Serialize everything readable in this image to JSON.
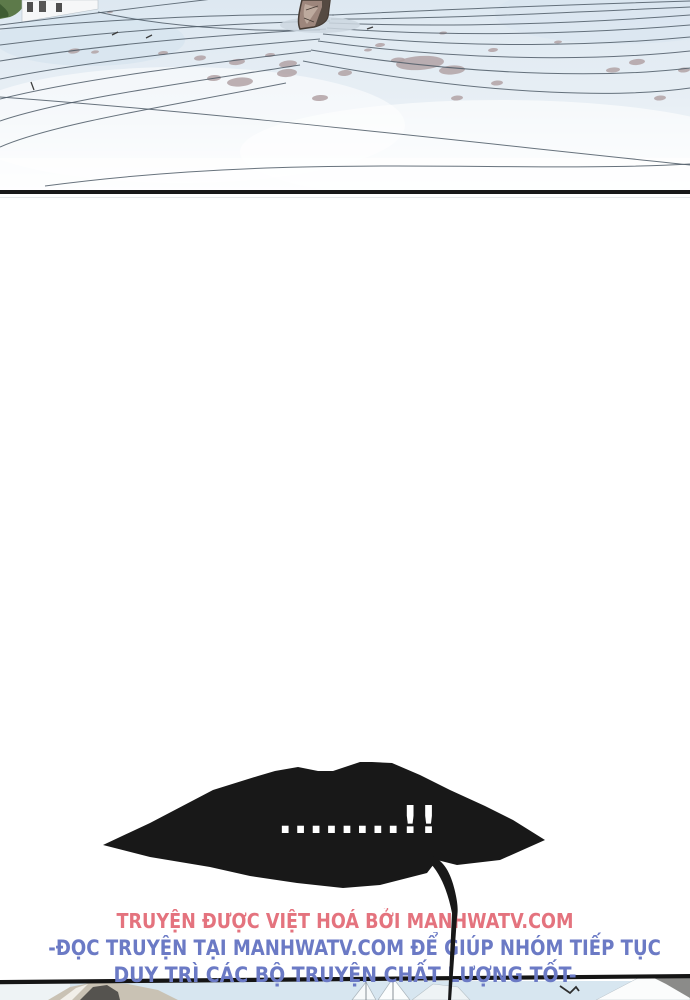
{
  "colors": {
    "panel_bg_top": "#dde8f1",
    "panel_bg_bottom": "#fbfdfe",
    "contour_line": "#4e5a66",
    "stain": "#b2a2a4",
    "divider": "#191919",
    "bubble": "#181818",
    "bubble_text": "#ffffff",
    "credit_line1": "#e4737e",
    "credit_line23": "#6b7ac5",
    "sky": "#d7e6f0"
  },
  "speech_bubble": {
    "text": "........!!"
  },
  "credits": {
    "line1": "TRUYỆN ĐƯỢC VIỆT HOÁ BỞI MANHWATV.COM",
    "line2": "-ĐỌC TRUYỆN TẠI MANHWATV.COM ĐỂ GIÚP NHÓM TIẾP TỤC",
    "line3": "DUY TRÌ CÁC BỘ TRUYỆN CHẤT LƯỢNG TỐT-"
  },
  "artwork": {
    "stains": [
      [
        74,
        51,
        6,
        2.5,
        -8
      ],
      [
        95,
        52,
        4,
        1.6,
        -8
      ],
      [
        163,
        53,
        5,
        2,
        -6
      ],
      [
        200,
        58,
        6,
        2.5,
        -6
      ],
      [
        237,
        62,
        8,
        3,
        -6
      ],
      [
        270,
        55,
        5,
        2,
        -6
      ],
      [
        288,
        64,
        9,
        3.5,
        -6
      ],
      [
        240,
        82,
        13,
        4.5,
        -4
      ],
      [
        214,
        78,
        7,
        3,
        -4
      ],
      [
        287,
        73,
        10,
        4,
        -5
      ],
      [
        320,
        98,
        8,
        3,
        -4
      ],
      [
        345,
        73,
        7,
        3,
        -5
      ],
      [
        380,
        45,
        5,
        2,
        -6
      ],
      [
        443,
        33,
        4,
        1.5,
        -6
      ],
      [
        420,
        63,
        24,
        7,
        -4
      ],
      [
        452,
        70,
        13,
        4.5,
        -4
      ],
      [
        398,
        60,
        7,
        2.5,
        -4
      ],
      [
        493,
        50,
        5,
        2,
        -6
      ],
      [
        497,
        83,
        6,
        2.5,
        -5
      ],
      [
        457,
        98,
        6,
        2.5,
        -5
      ],
      [
        613,
        70,
        7,
        2.5,
        -5
      ],
      [
        637,
        62,
        8,
        3,
        -5
      ],
      [
        660,
        98,
        6,
        2.5,
        -5
      ],
      [
        684,
        70,
        6,
        2.5,
        -5
      ],
      [
        558,
        42,
        4,
        1.5,
        -5
      ],
      [
        368,
        50,
        4,
        1.5,
        -5
      ],
      [
        110,
        12,
        3,
        1.2,
        -5
      ]
    ],
    "contours": [
      "M332,15 C430,10 560,5 690,1",
      "M331,19 C445,19 575,12 690,7",
      "M329,23 C455,28 585,23 690,15",
      "M327,28 C465,38 595,33 690,25",
      "M323,34 C475,50 605,45 690,37",
      "M318,41 C485,64 615,59 690,51",
      "M311,50 C495,80 625,76 690,68",
      "M303,61 C505,100 635,96 690,88",
      "M334,15 C240,13 120,19 0,29",
      "M330,21 C230,23 110,31 0,45",
      "M326,29 C215,35 100,45 0,61",
      "M320,39 C205,49 90,61 0,79",
      "M311,51 C195,65 80,79 0,99",
      "M300,65 C185,83 65,99 0,121",
      "M286,83 C175,105 55,123 0,147",
      "M0,97 C220,113 460,141 690,165",
      "M45,186 C300,152 520,174 690,164",
      "M0,25 C70,16 160,5 238,-4",
      "M98,12 C160,26 240,32 320,30"
    ],
    "marks": [
      [
        112,
        35,
        118,
        32
      ],
      [
        31,
        82,
        34,
        90
      ],
      [
        146,
        38,
        152,
        35
      ],
      [
        367,
        29,
        373,
        27
      ]
    ]
  }
}
